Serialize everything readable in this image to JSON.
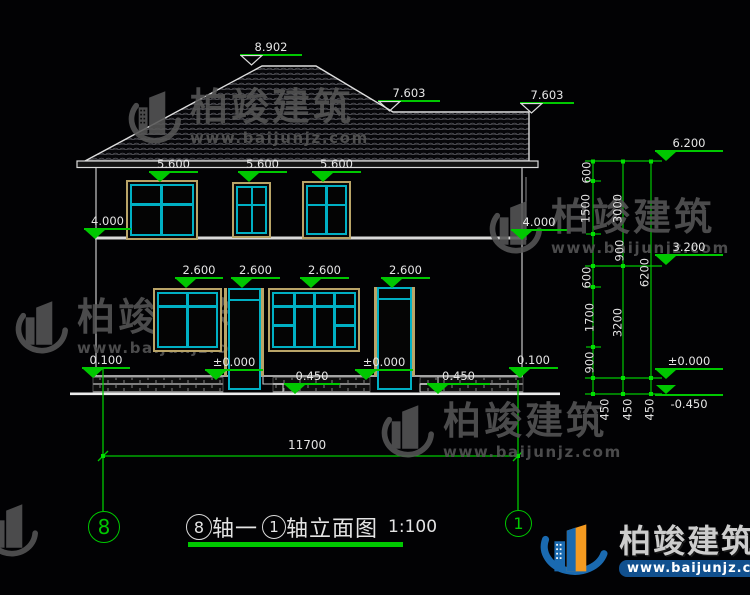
{
  "drawing": {
    "elevation_markers": [
      "8.902",
      "7.603",
      "7.603",
      "5.600",
      "5.600",
      "5.600",
      "4.000",
      "4.000",
      "2.600",
      "2.600",
      "2.600",
      "2.600",
      "0.100",
      "±0.000",
      "0.450",
      "±0.000",
      "0.450",
      "0.100",
      "6.200",
      "3.200",
      "±0.000",
      "-0.450"
    ],
    "dimensions": {
      "right_inner": [
        "600",
        "1500",
        "900",
        "600",
        "1700",
        "900"
      ],
      "right_middle": [
        "3000",
        "3200"
      ],
      "right_outer": [
        "6200"
      ],
      "foundation": [
        "450",
        "450",
        "450"
      ],
      "total_width": "11700"
    },
    "axis_bubbles": {
      "left": "8",
      "right": "1"
    },
    "title": {
      "axis_left_bubble": "8",
      "axis_join": "轴一",
      "axis_right_bubble": "1",
      "suffix": "轴立面图",
      "scale": "1:100"
    },
    "watermark": {
      "brand": "柏竣建筑",
      "url": "www.baijunjz.com"
    },
    "footer_logo": {
      "brand": "柏竣建筑",
      "url": "www.baijunjz.com"
    }
  }
}
